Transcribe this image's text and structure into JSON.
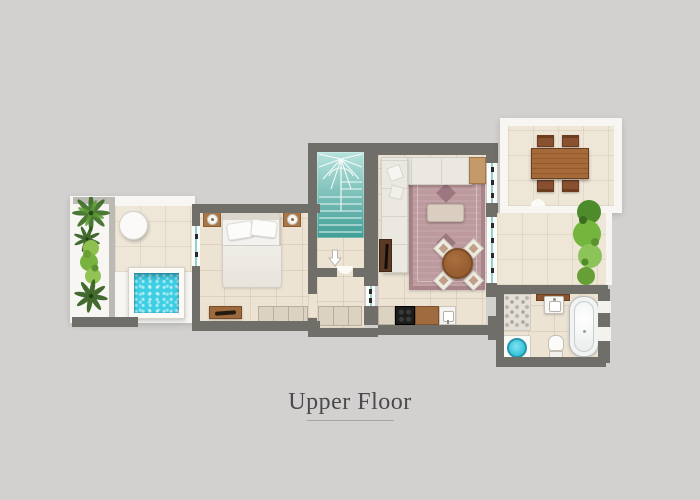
{
  "title": {
    "label": "Upper Floor"
  },
  "plan_features": [
    "palm-trees",
    "hedge-strip",
    "round-patio-table",
    "plunge-pool",
    "double-bed",
    "pillows",
    "nightstand-with-lamp",
    "foot-bench",
    "built-in-wardrobe",
    "winder-staircase",
    "entry-arrow",
    "door-arc",
    "sectional-sofa",
    "throw-pillows",
    "area-rug",
    "ottoman-coffee-table",
    "round-dining-table",
    "dining-chairs",
    "tv-console",
    "side-table",
    "kitchen-counter",
    "cooktop",
    "kitchen-sink",
    "glass-wall",
    "glass-door",
    "window",
    "outdoor-dining-table",
    "outdoor-chairs",
    "garden-shrubs",
    "pebble-shower-floor",
    "round-shower-basin",
    "vanity-sink",
    "toilet",
    "bathtub",
    "wall-niche"
  ],
  "colors": {
    "background": "#d2d1cf",
    "wall": "#6f6e68",
    "floor_tile": "#ece3d3",
    "terrace_tile": "#eee6d7",
    "terrace_deck": "#f7f6f2",
    "stairs_top": "#b7e2dc",
    "stairs_bottom": "#3f9e96",
    "pool_water": "#3ecfe4",
    "rug": "#bd9a9e",
    "sofa": "#eae8e1",
    "wood": "#9a6134",
    "wood_dark": "#6d3d20",
    "hedge_green": "#74b53e",
    "palm_green": "#3a6b22",
    "glass_teal": "#8fd2cb",
    "label_text": "#4a4a4c"
  }
}
